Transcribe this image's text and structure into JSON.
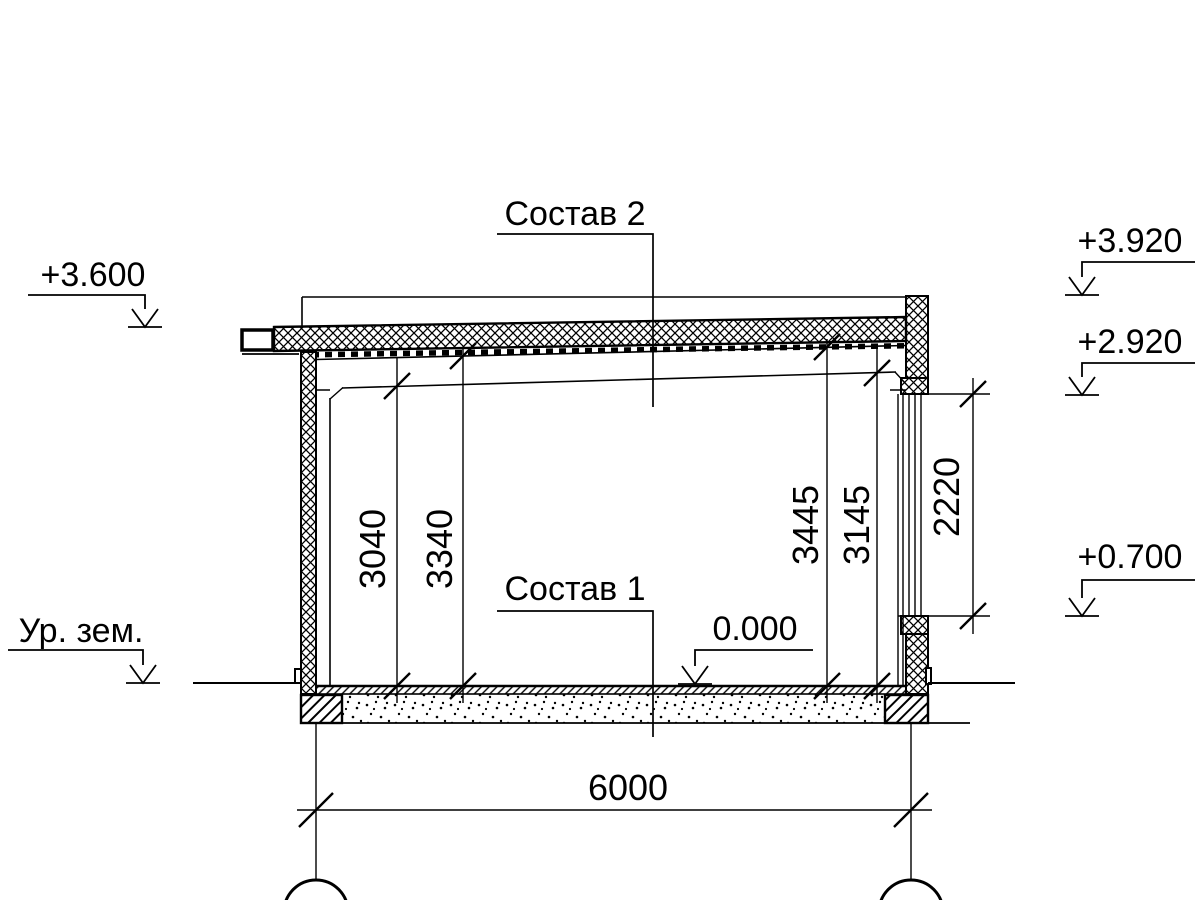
{
  "drawing": {
    "callouts": {
      "roof": "Состав 2",
      "floor": "Состав 1"
    },
    "elevations": {
      "roof_edge_left": "+3.600",
      "parapet_top": "+3.920",
      "lintel": "+2.920",
      "sill": "+0.700",
      "floor_level": "0.000",
      "ground": "Ур. зем."
    },
    "dimensions": {
      "h_left_clear": "3040",
      "h_left_deck": "3340",
      "h_right_deck": "3445",
      "h_right_clear": "3145",
      "opening": "2220",
      "span": "6000"
    },
    "colors": {
      "line": "#000000",
      "background": "#ffffff"
    }
  }
}
